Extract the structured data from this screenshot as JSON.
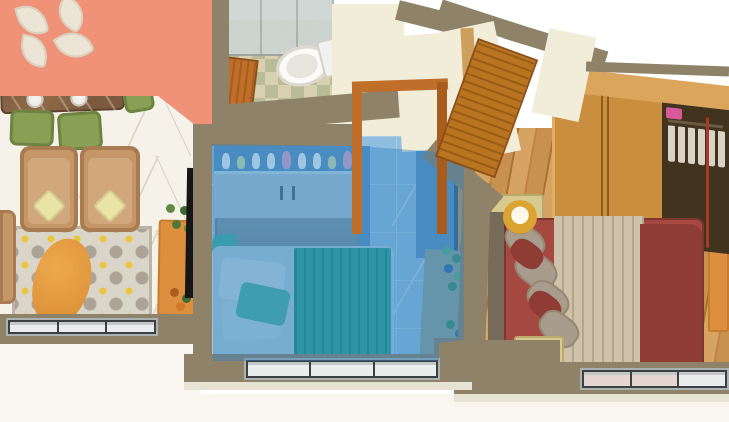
{
  "scene": {
    "kind": "3d-apartment-floor-plan-render",
    "background": "#ffffff",
    "highlighted_room": "bedroom-center"
  },
  "rooms": [
    {
      "id": "living-dining",
      "highlighted": false
    },
    {
      "id": "bathroom",
      "highlighted": false
    },
    {
      "id": "bedroom-center",
      "highlighted": true,
      "highlight_color": "#2f84c6"
    },
    {
      "id": "bedroom-right",
      "highlighted": false
    }
  ],
  "palette": {
    "wall_cap": "#8e8268",
    "wall_face": "#f2edd9",
    "peach_wall": "#ef9277",
    "leaf_decor": "#ece5d6",
    "marble_floor": "#f5f2ea",
    "marble_vein": "#ddd5c5",
    "tile_a": "#d7d1b2",
    "tile_b": "#b9bc96",
    "glass": "#cdd5d2",
    "toilet_white": "#f3f1ed",
    "wood_door": "#c06f2b",
    "wood_door_dark": "#8f4f16",
    "door_frame_light": "#cda05b",
    "wood_floor": "#c8914f",
    "wood_floor_mid": "#d6a362",
    "wood_floor_dark": "#a9722f",
    "wardrobe_wood": "#c98e3e",
    "wardrobe_wood_top": "#dca55c",
    "wardrobe_dark": "#42331f",
    "clothes_white": "#d9d3c6",
    "pole_red": "#a33a2a",
    "pink_box": "#d85a9a",
    "table_brown": "#7b5a3f",
    "chair_green": "#87a054",
    "plate_white": "#f4f2ee",
    "sofa_tan": "#c49668",
    "sofa_tan_dark": "#a87c50",
    "cushion_yellow": "#e9e4a6",
    "rug_base": "#dad5c9",
    "rug_motif": "#aaa396",
    "rug_accent": "#ecc53f",
    "beanbag_orange": "#e49a42",
    "runner_orange": "#dd8f3e",
    "plant_green": "#5f8a42",
    "plant_dark": "#3e6b34",
    "tv_black": "#161616",
    "highlight_blue": "#2f84c6",
    "blue_floor": "#8fbede",
    "blue_tile_line": "#a9cfe8",
    "blue_cabinet": "#a9c4d2",
    "blue_cabinet_low": "#7f98a4",
    "blue_shelf": "#bcd9e6",
    "blue_side": "#5b93c0",
    "desk_sage": "#8aa398",
    "teal_bed": "#2da391",
    "teal_dark": "#1f8a7a",
    "teal_head": "#3fae9d",
    "blue_mattress": "#a9cbd8",
    "figurine_white": "#eef4f6",
    "figurine_pink": "#d8a8c8",
    "figurine_green": "#cfe0a8",
    "bed_maroon": "#a5483f",
    "bed_maroon_dark": "#8e3c34",
    "blanket_beige": "#cfc2ab",
    "blanket_crease": "#b3a68d",
    "pillow_gray": "#a89c8c",
    "headboard_gray": "#756b58",
    "nightstand": "#d8c98f",
    "lamp_gold": "#d9a431",
    "lamp_glow": "#fdf8ea",
    "window_frame": "#aab2b2",
    "window_dark": "#3c4043",
    "window_pane": "#e9edec",
    "window_pane_pink": "#e6d6d2",
    "exterior": "#f8f6ee",
    "shadow_band": "#e6e2d4"
  }
}
